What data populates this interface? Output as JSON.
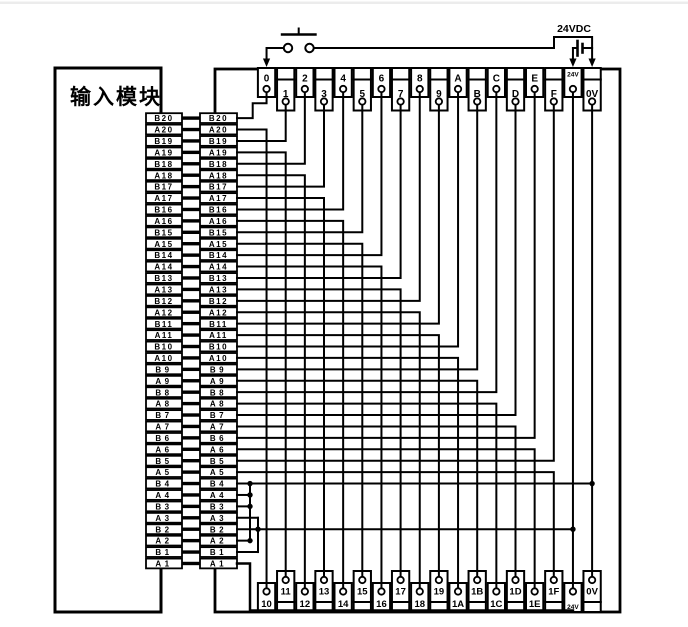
{
  "module": {
    "label": "输入模块"
  },
  "power": {
    "label": "24VDC",
    "switch": "pushbutton",
    "rails": [
      "24V",
      "0V"
    ]
  },
  "connector_pins": [
    "B20",
    "A20",
    "B19",
    "A19",
    "B18",
    "A18",
    "B17",
    "A17",
    "B16",
    "A16",
    "B15",
    "A15",
    "B14",
    "A14",
    "B13",
    "A13",
    "B12",
    "A12",
    "B11",
    "A11",
    "B10",
    "A10",
    "B9",
    "A9",
    "B8",
    "A8",
    "B7",
    "A7",
    "B6",
    "A6",
    "B5",
    "A5",
    "B4",
    "A4",
    "B3",
    "A3",
    "B2",
    "A2",
    "B1",
    "A1"
  ],
  "top_terminals": [
    "0",
    "1",
    "2",
    "3",
    "4",
    "5",
    "6",
    "7",
    "8",
    "9",
    "A",
    "B",
    "C",
    "D",
    "E",
    "F",
    "24V",
    "0V"
  ],
  "bottom_terminals": [
    "10",
    "11",
    "12",
    "13",
    "14",
    "15",
    "16",
    "17",
    "18",
    "19",
    "1A",
    "1B",
    "1C",
    "1D",
    "1E",
    "1F",
    "24V",
    "0V"
  ],
  "wiring": {
    "top": [
      {
        "pin": "B20",
        "terminal": "0"
      },
      {
        "pin": "B19",
        "terminal": "1"
      },
      {
        "pin": "B18",
        "terminal": "2"
      },
      {
        "pin": "B17",
        "terminal": "3"
      },
      {
        "pin": "B16",
        "terminal": "4"
      },
      {
        "pin": "B15",
        "terminal": "5"
      },
      {
        "pin": "B14",
        "terminal": "6"
      },
      {
        "pin": "B13",
        "terminal": "7"
      },
      {
        "pin": "B12",
        "terminal": "8"
      },
      {
        "pin": "B11",
        "terminal": "9"
      },
      {
        "pin": "B10",
        "terminal": "A"
      },
      {
        "pin": "B9",
        "terminal": "B"
      },
      {
        "pin": "B8",
        "terminal": "C"
      },
      {
        "pin": "B7",
        "terminal": "D"
      },
      {
        "pin": "B6",
        "terminal": "E"
      },
      {
        "pin": "B5",
        "terminal": "F"
      }
    ],
    "bottom": [
      {
        "pin": "A20",
        "terminal": "10"
      },
      {
        "pin": "A19",
        "terminal": "11"
      },
      {
        "pin": "A18",
        "terminal": "12"
      },
      {
        "pin": "A17",
        "terminal": "13"
      },
      {
        "pin": "A16",
        "terminal": "14"
      },
      {
        "pin": "A15",
        "terminal": "15"
      },
      {
        "pin": "A14",
        "terminal": "16"
      },
      {
        "pin": "A13",
        "terminal": "17"
      },
      {
        "pin": "A12",
        "terminal": "18"
      },
      {
        "pin": "A11",
        "terminal": "19"
      },
      {
        "pin": "A10",
        "terminal": "1A"
      },
      {
        "pin": "A9",
        "terminal": "1B"
      },
      {
        "pin": "A8",
        "terminal": "1C"
      },
      {
        "pin": "A7",
        "terminal": "1D"
      },
      {
        "pin": "A6",
        "terminal": "1E"
      },
      {
        "pin": "A5",
        "terminal": "1F"
      }
    ],
    "common": [
      {
        "pins": [
          "B4",
          "A4",
          "B3",
          "A2"
        ],
        "rail": "0V"
      },
      {
        "pins": [
          "A3",
          "B2",
          "B1"
        ],
        "rail": "24V"
      },
      {
        "pins": [
          "A1"
        ],
        "rail": "24V-bottom"
      }
    ],
    "switch_between": [
      "24VDC",
      "terminal 0"
    ]
  },
  "colors": {
    "line": "#000000",
    "background": "#ffffff",
    "top_edge": "#ececec"
  }
}
